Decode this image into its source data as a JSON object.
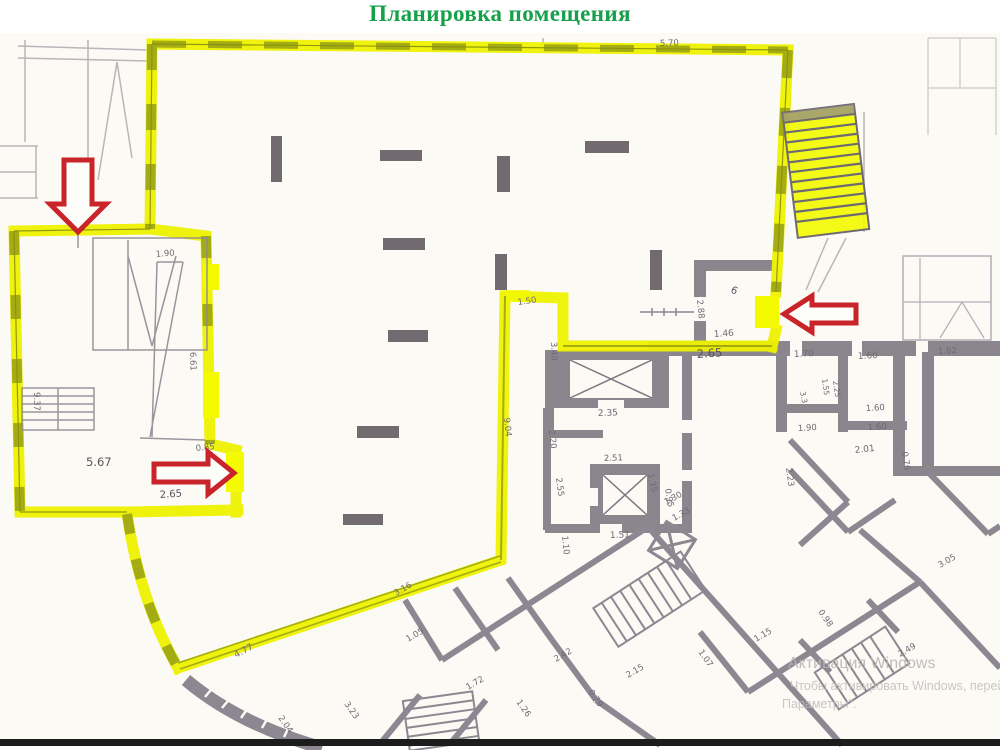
{
  "title": "Планировка помещения",
  "colors": {
    "title_green": "#17a04a",
    "highlight_yellow": "#eef200",
    "door_yellow": "#f4fa00",
    "hatch_olive": "#97a013",
    "wall_gray": "#8b858d",
    "line_gray": "#7c7680",
    "arrow_red": "#c8242a",
    "dim_text": "#6f6974",
    "watermark_gray": "#b9b3b4",
    "paper": "#fbfaf5"
  },
  "watermark": {
    "line1": "Активация Windows",
    "line2": "Чтобы активировать Windows, перейдите",
    "line3": "Параметры\"."
  },
  "plan": {
    "dims": [
      "5.70",
      "5.67",
      "2.65",
      "0.85",
      "9.37",
      "1.90",
      "6.61",
      "1.50",
      "3.40",
      "9.04",
      "4.77",
      "3.16",
      "1.46",
      "2.65",
      "2.88",
      "6",
      "1.70",
      "1.60",
      "2.35",
      "2.51",
      "1.51",
      "1.10",
      "0.95",
      "1.30",
      "1.33",
      "2.20",
      "1.90",
      "1.60",
      "1.60",
      "2.23",
      "0.76",
      "2.01",
      "3.05",
      "1.35",
      "1.05",
      "2.04",
      "3.23",
      "1.72",
      "1.26",
      "2.42",
      "0.79",
      "2.15",
      "1.07",
      "1.15",
      "0.98",
      "2.49",
      "1.62",
      "1.55",
      "2.25",
      "3.3",
      "2.55"
    ]
  }
}
